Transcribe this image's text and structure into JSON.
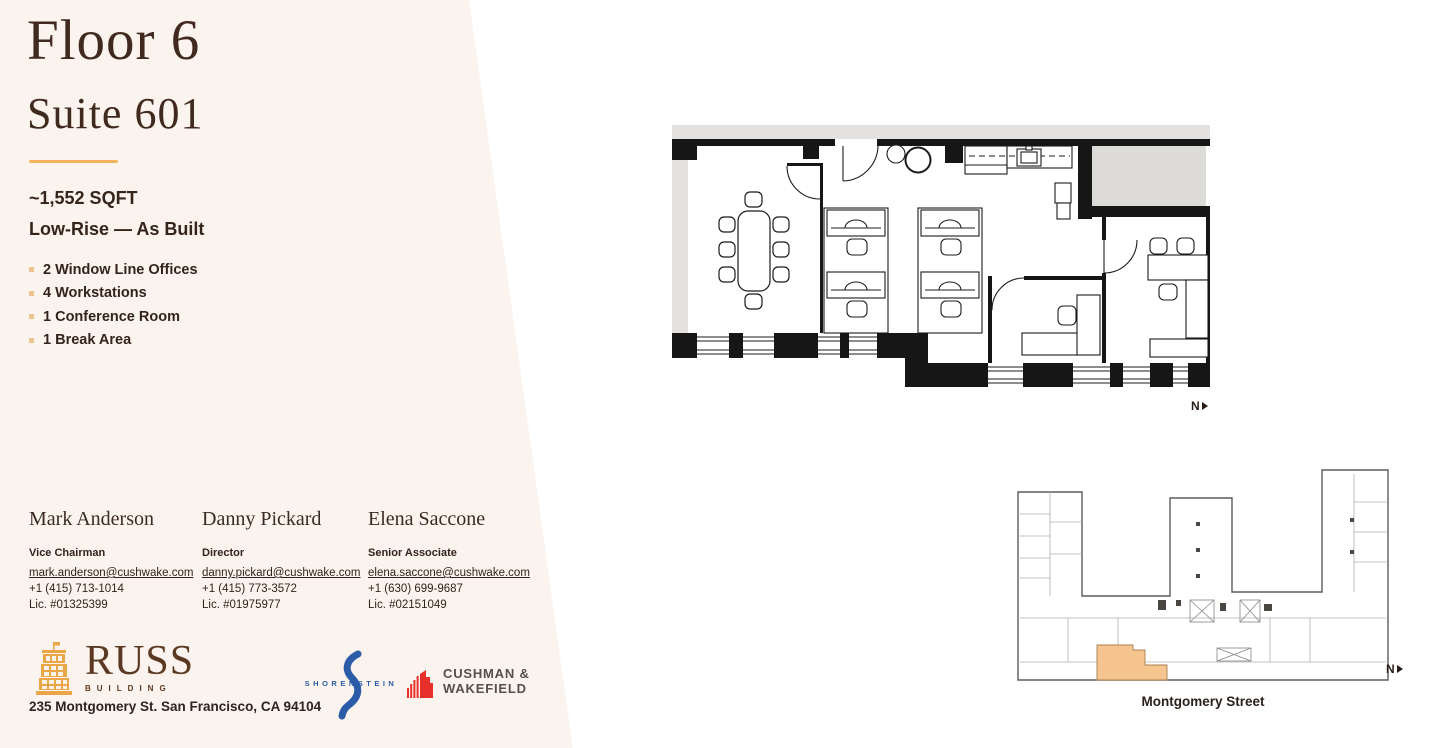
{
  "colors": {
    "panel": "#fbf4ee",
    "accent": "#f2b55e",
    "ink": "#35241b",
    "suite_highlight": "#f5c48f",
    "shorenstein_blue": "#2a5ca8",
    "cushman_red": "#e63029",
    "russ_gold": "#eba647",
    "russ_brown": "#5b3822"
  },
  "header": {
    "floor_title": "Floor 6",
    "suite_title": "Suite 601"
  },
  "summary": {
    "sqft": "~1,552 SQFT",
    "build": "Low-Rise — As Built"
  },
  "features": [
    "2 Window Line Offices",
    "4 Workstations",
    "1 Conference Room",
    "1 Break Area"
  ],
  "contacts": [
    {
      "name": "Mark Anderson",
      "title": "Vice Chairman",
      "email": "mark.anderson@cushwake.com",
      "phone": "+1 (415) 713-1014",
      "license": "Lic. #01325399"
    },
    {
      "name": "Danny Pickard",
      "title": "Director",
      "email": "danny.pickard@cushwake.com",
      "phone": "+1 (415) 773-3572",
      "license": "Lic. #01975977"
    },
    {
      "name": "Elena Saccone",
      "title": "Senior Associate",
      "email": "elena.saccone@cushwake.com",
      "phone": "+1 (630) 699-9687",
      "license": "Lic. #02151049"
    }
  ],
  "brands": {
    "russ_name": "RUSS",
    "russ_sub": "BUILDING",
    "address": "235 Montgomery St. San Francisco, CA 94104",
    "shorenstein": "SHORENSTEIN",
    "cushman_line1": "CUSHMAN &",
    "cushman_line2": "WAKEFIELD"
  },
  "plan": {
    "north_label": "N"
  },
  "keyplan": {
    "street_label": "Montgomery Street",
    "north_label": "N"
  }
}
